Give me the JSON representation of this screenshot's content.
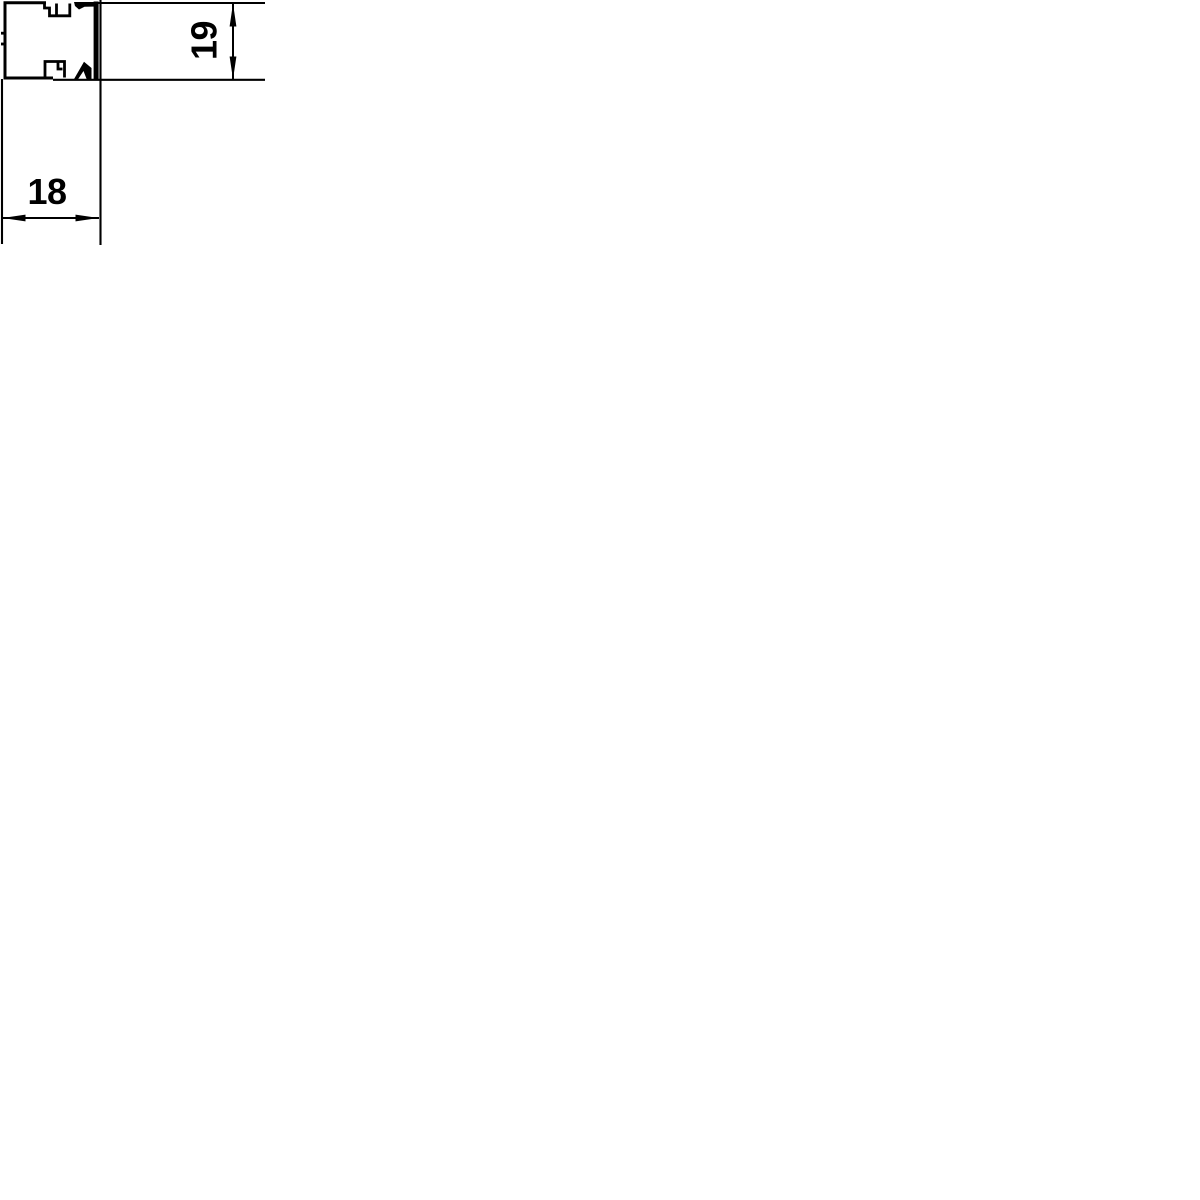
{
  "page": {
    "background_color": "#ffffff"
  },
  "drawing": {
    "description": "Dimension drawing: cross-section of a mini cable trunking body with snap-on cover",
    "line_color": "#000000",
    "dimensions": {
      "width_mm": {
        "label": "18"
      },
      "height_mm": {
        "label": "19"
      }
    }
  }
}
